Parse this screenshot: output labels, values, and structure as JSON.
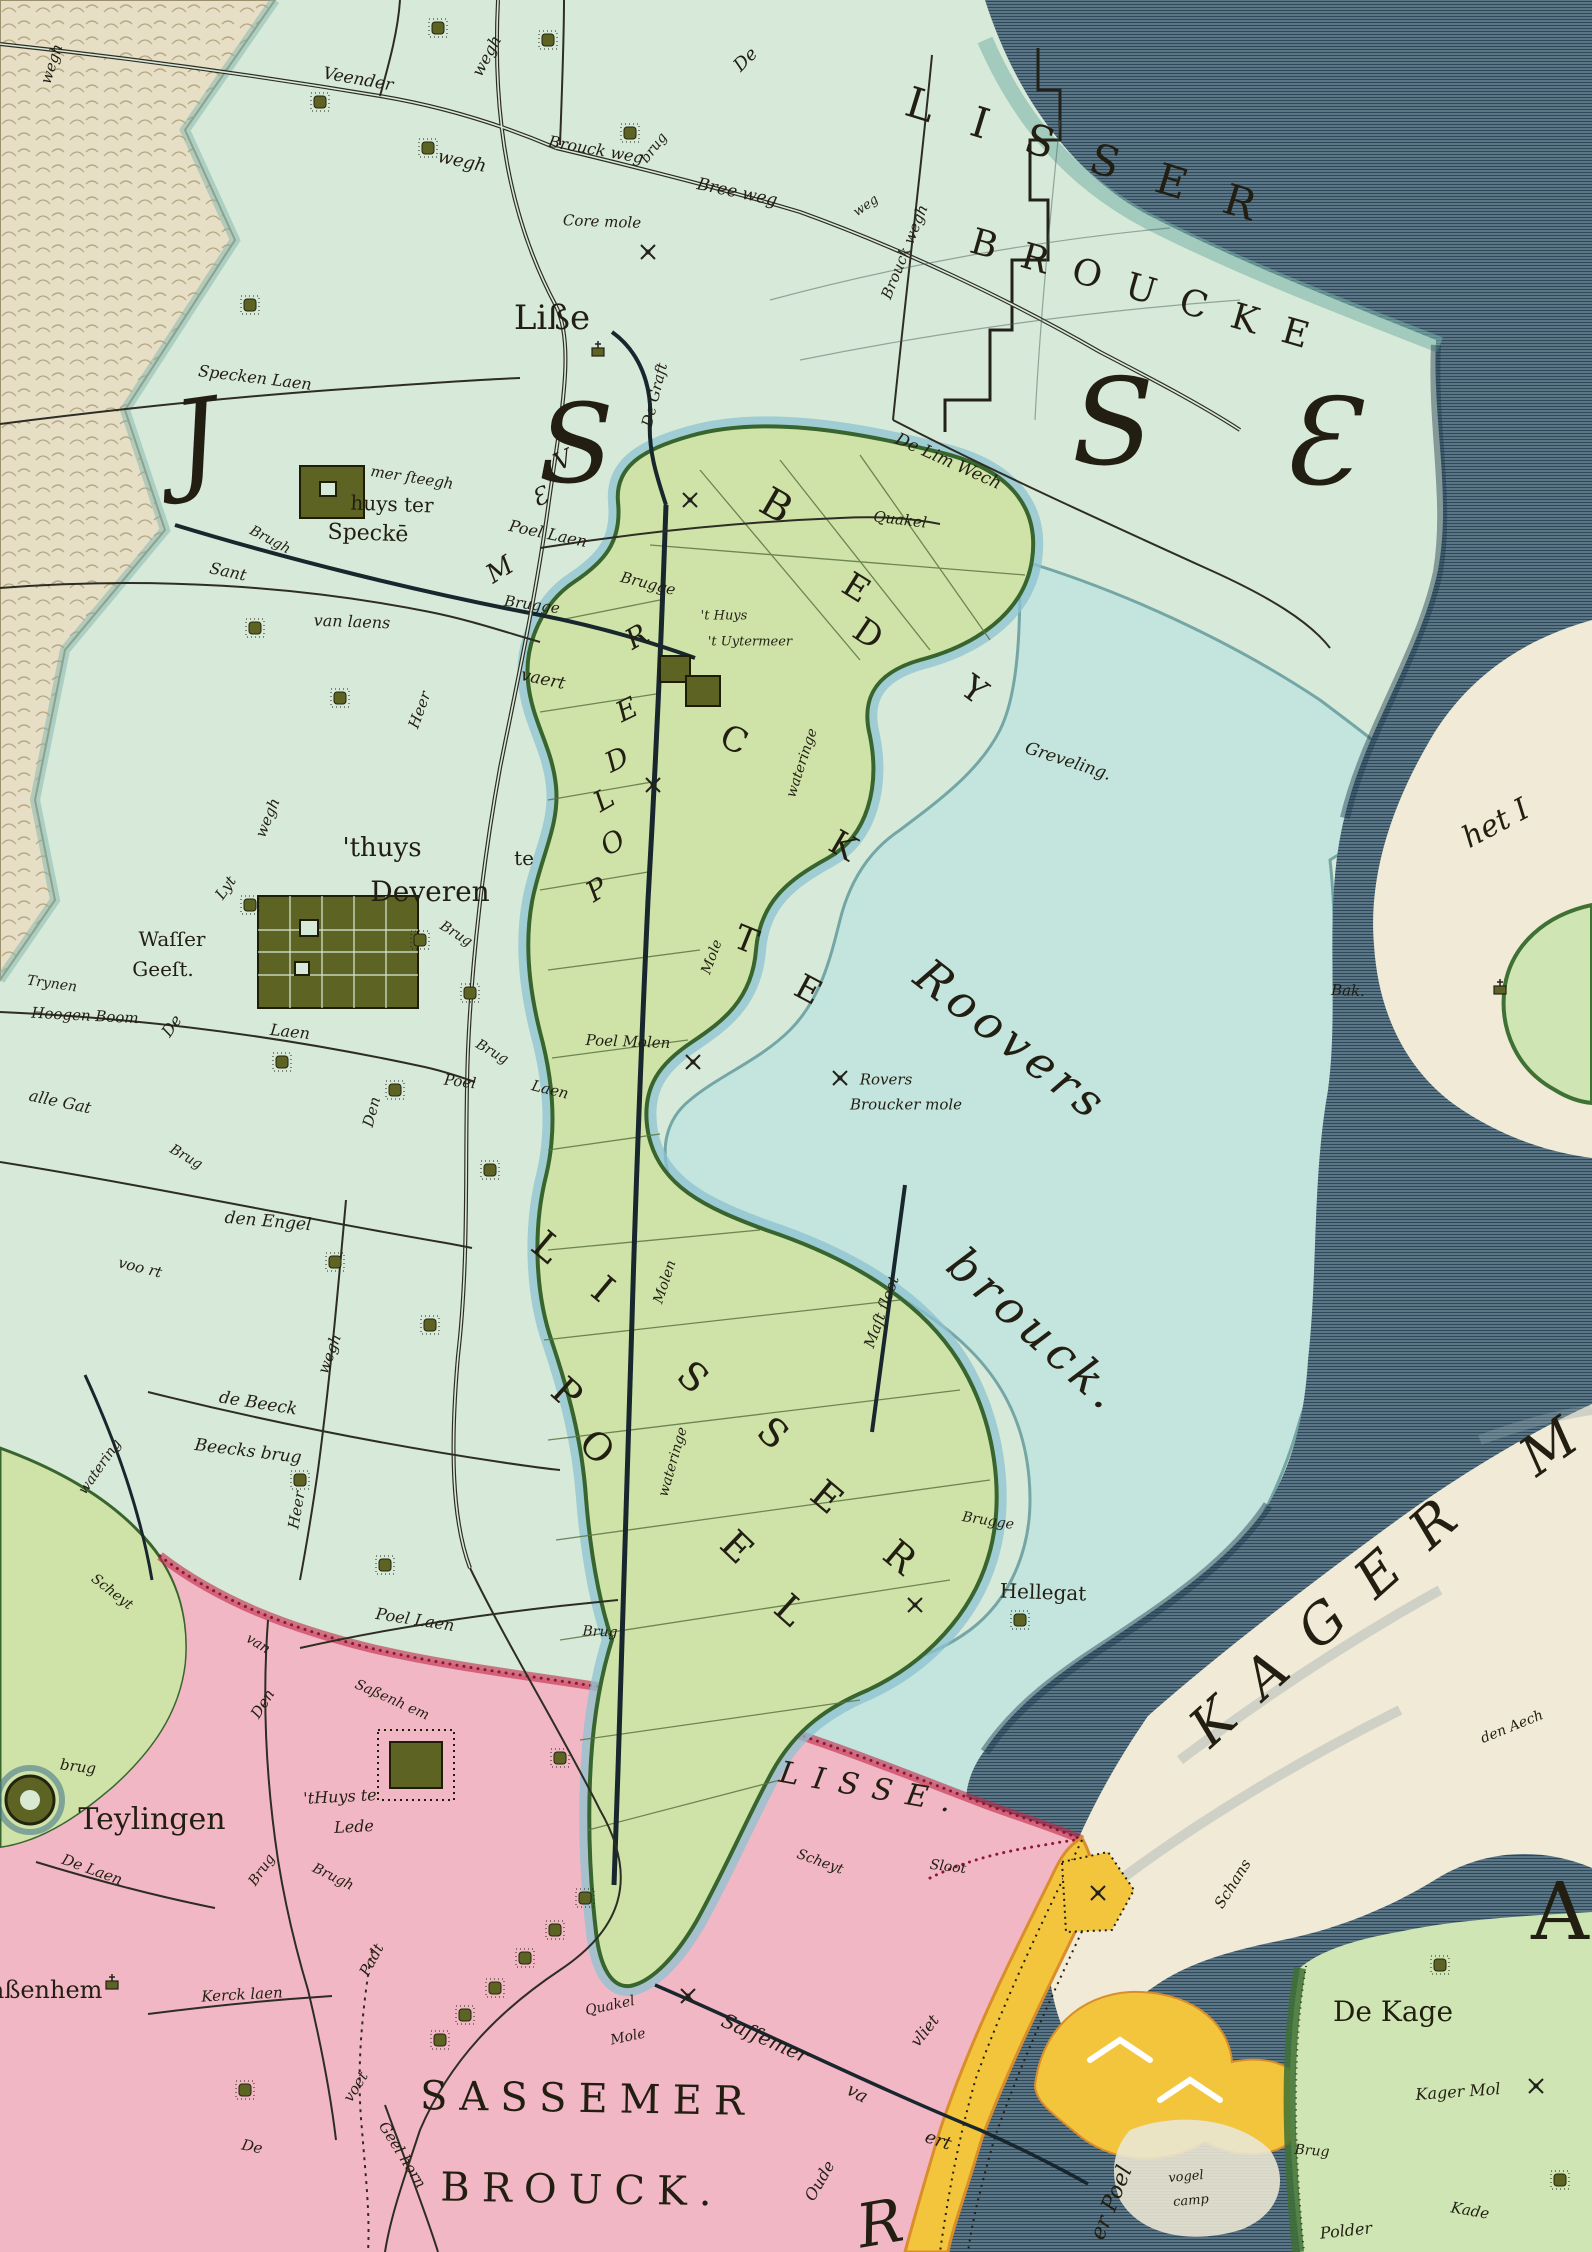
{
  "map_type": "historic-hand-coloured-map",
  "palette": {
    "land_mint": "#d7e9d8",
    "water_light_cyan": "#c3e4df",
    "water_dark": "#5b7585",
    "water_dark_lines": "#2d4a5c",
    "polder_green": "#cfe3a9",
    "polder_rim_green": "#38652e",
    "ring_canal_blue": "#8cc3d2",
    "pink_region": "#f2b7c4",
    "crimson_border": "#c22648",
    "yellow_dike": "#f2c53d",
    "cream_meer": "#f0ead6",
    "dune_sand": "#e6dfc6",
    "island_green": "#cfe6b4",
    "olive_wood": "#5d6322",
    "ink": "#23221a"
  },
  "labels": [
    {
      "id": "wegh_dune",
      "t": "wegh",
      "x": 52,
      "y": 64,
      "r": -72,
      "s": 15
    },
    {
      "id": "veender",
      "t": "Veender",
      "x": 358,
      "y": 80,
      "r": 10,
      "s": 17
    },
    {
      "id": "wegh_n",
      "t": "wegh",
      "x": 487,
      "y": 56,
      "r": -62,
      "s": 16
    },
    {
      "id": "wegh_w",
      "t": "wegh",
      "x": 462,
      "y": 162,
      "r": 12,
      "s": 18
    },
    {
      "id": "brouck_weg",
      "t": "Brouck weg",
      "x": 596,
      "y": 150,
      "r": 10,
      "s": 16
    },
    {
      "id": "brug_top",
      "t": "brug",
      "x": 654,
      "y": 148,
      "r": -52,
      "s": 14
    },
    {
      "id": "bree_weg",
      "t": "Bree weg",
      "x": 737,
      "y": 193,
      "r": 12,
      "s": 17
    },
    {
      "id": "core_mole",
      "t": "Core mole",
      "x": 602,
      "y": 222,
      "r": 2,
      "s": 15
    },
    {
      "id": "de_top",
      "t": "De",
      "x": 746,
      "y": 60,
      "r": -45,
      "s": 18
    },
    {
      "id": "brouck_wegh_v",
      "t": "Brouck wegh",
      "x": 905,
      "y": 252,
      "r": -68,
      "s": 15
    },
    {
      "id": "weg_sm",
      "t": "weg",
      "x": 866,
      "y": 206,
      "r": -35,
      "s": 13
    },
    {
      "id": "de_lim",
      "t": "De Lim Wech",
      "x": 948,
      "y": 462,
      "r": 24,
      "s": 17
    },
    {
      "id": "de_graft",
      "t": "De Graft",
      "x": 655,
      "y": 395,
      "r": -76,
      "s": 15
    },
    {
      "id": "specken_laen",
      "t": "Specken Laen",
      "x": 255,
      "y": 378,
      "r": 7,
      "s": 16
    },
    {
      "id": "mer_steegh",
      "t": "mer ſteegh",
      "x": 412,
      "y": 478,
      "r": 9,
      "s": 15
    },
    {
      "id": "poel_laen_n",
      "t": "Poel Laen",
      "x": 548,
      "y": 534,
      "r": 12,
      "s": 16
    },
    {
      "id": "brugh_w",
      "t": "Brugh",
      "x": 270,
      "y": 540,
      "r": 28,
      "s": 14
    },
    {
      "id": "sant",
      "t": "Sant",
      "x": 228,
      "y": 572,
      "r": 12,
      "s": 16
    },
    {
      "id": "van_laens",
      "t": "van laens",
      "x": 352,
      "y": 622,
      "r": 2,
      "s": 16
    },
    {
      "id": "brugge1",
      "t": "Brugge",
      "x": 532,
      "y": 605,
      "r": 8,
      "s": 15
    },
    {
      "id": "brugge2",
      "t": "Brugge",
      "x": 648,
      "y": 584,
      "r": 14,
      "s": 15
    },
    {
      "id": "vaert",
      "t": "vaert",
      "x": 543,
      "y": 680,
      "r": 12,
      "s": 17
    },
    {
      "id": "heer1",
      "t": "Heer",
      "x": 420,
      "y": 710,
      "r": -70,
      "s": 15
    },
    {
      "id": "quakel",
      "t": "Quakel",
      "x": 900,
      "y": 520,
      "r": 7,
      "s": 15
    },
    {
      "id": "uyter1",
      "t": "'t Huys",
      "x": 724,
      "y": 616,
      "r": 0,
      "s": 13
    },
    {
      "id": "uyter2",
      "t": "'t Uytermeer",
      "x": 750,
      "y": 642,
      "r": 0,
      "s": 13
    },
    {
      "id": "wateringe1",
      "t": "wateringe",
      "x": 802,
      "y": 763,
      "r": -72,
      "s": 14
    },
    {
      "id": "greveling",
      "t": "Greveling.",
      "x": 1068,
      "y": 762,
      "r": 18,
      "s": 17
    },
    {
      "id": "mole_v",
      "t": "Mole",
      "x": 712,
      "y": 957,
      "r": -70,
      "s": 14
    },
    {
      "id": "poel_molen",
      "t": "Poel Molen",
      "x": 628,
      "y": 1042,
      "r": 2,
      "s": 15
    },
    {
      "id": "rovers1",
      "t": "Rovers",
      "x": 886,
      "y": 1080,
      "r": 0,
      "s": 15
    },
    {
      "id": "rovers2",
      "t": "Broucker mole",
      "x": 906,
      "y": 1105,
      "r": 0,
      "s": 15
    },
    {
      "id": "mast_sloot",
      "t": "Maſt ſloot",
      "x": 882,
      "y": 1312,
      "r": -70,
      "s": 15
    },
    {
      "id": "lyt",
      "t": "Lyt",
      "x": 226,
      "y": 888,
      "r": -55,
      "s": 15
    },
    {
      "id": "wegh_lyt",
      "t": "wegh",
      "x": 268,
      "y": 818,
      "r": -68,
      "s": 15
    },
    {
      "id": "trynen",
      "t": "Trynen",
      "x": 52,
      "y": 984,
      "r": 8,
      "s": 14
    },
    {
      "id": "hoogen",
      "t": "Hoogen Boom",
      "x": 85,
      "y": 1016,
      "r": 3,
      "s": 15
    },
    {
      "id": "de_v",
      "t": "De",
      "x": 172,
      "y": 1026,
      "r": -55,
      "s": 16
    },
    {
      "id": "laen_dev",
      "t": "Laen",
      "x": 290,
      "y": 1032,
      "r": 6,
      "s": 16
    },
    {
      "id": "alle_gat",
      "t": "alle Gat",
      "x": 60,
      "y": 1102,
      "r": 12,
      "s": 16
    },
    {
      "id": "brug_sw",
      "t": "Brug",
      "x": 186,
      "y": 1157,
      "r": 30,
      "s": 14
    },
    {
      "id": "brug_dev",
      "t": "Brug",
      "x": 456,
      "y": 934,
      "r": 32,
      "s": 14
    },
    {
      "id": "brug_poel",
      "t": "Brug",
      "x": 492,
      "y": 1052,
      "r": 30,
      "s": 14
    },
    {
      "id": "poel_s",
      "t": "Poel",
      "x": 460,
      "y": 1082,
      "r": 7,
      "s": 15
    },
    {
      "id": "den_v",
      "t": "Den",
      "x": 372,
      "y": 1112,
      "r": -75,
      "s": 15
    },
    {
      "id": "laen_ps",
      "t": "Laen",
      "x": 550,
      "y": 1090,
      "r": 14,
      "s": 15
    },
    {
      "id": "den_engel",
      "t": "den Engel",
      "x": 268,
      "y": 1222,
      "r": 5,
      "s": 17
    },
    {
      "id": "voort",
      "t": "voo rt",
      "x": 140,
      "y": 1268,
      "r": 14,
      "s": 15
    },
    {
      "id": "wegh_s",
      "t": "wegh",
      "x": 330,
      "y": 1354,
      "r": -70,
      "s": 15
    },
    {
      "id": "de_beeck",
      "t": "de Beeck",
      "x": 258,
      "y": 1404,
      "r": 9,
      "s": 17
    },
    {
      "id": "beecks_brug",
      "t": "Beecks brug",
      "x": 248,
      "y": 1452,
      "r": 7,
      "s": 17
    },
    {
      "id": "watering_v",
      "t": "watering",
      "x": 100,
      "y": 1467,
      "r": -55,
      "s": 14
    },
    {
      "id": "heer2",
      "t": "Heer",
      "x": 297,
      "y": 1510,
      "r": -80,
      "s": 15
    },
    {
      "id": "molen_v",
      "t": "Molen",
      "x": 665,
      "y": 1282,
      "r": -72,
      "s": 14
    },
    {
      "id": "wateringe2",
      "t": "wateringe",
      "x": 673,
      "y": 1462,
      "r": -74,
      "s": 14
    },
    {
      "id": "brug_pold",
      "t": "Brug",
      "x": 600,
      "y": 1632,
      "r": 2,
      "s": 14
    },
    {
      "id": "brugge3",
      "t": "Brugge",
      "x": 988,
      "y": 1521,
      "r": 9,
      "s": 14
    },
    {
      "id": "hellegat",
      "t": "Hellegat",
      "x": 1043,
      "y": 1592,
      "r": 2,
      "s": 20,
      "c": "up"
    },
    {
      "id": "scheyt1",
      "t": "Scheyt",
      "x": 820,
      "y": 1862,
      "r": 20,
      "s": 14
    },
    {
      "id": "sloot1",
      "t": "Sloot",
      "x": 948,
      "y": 1867,
      "r": 7,
      "s": 14
    },
    {
      "id": "scheyt2",
      "t": "Scheyt",
      "x": 112,
      "y": 1592,
      "r": 38,
      "s": 14
    },
    {
      "id": "van2",
      "t": "van",
      "x": 258,
      "y": 1644,
      "r": 32,
      "s": 14
    },
    {
      "id": "sassenh2",
      "t": "Saßenh em",
      "x": 392,
      "y": 1700,
      "r": 24,
      "s": 14
    },
    {
      "id": "poel_laen_s",
      "t": "Poel Laen",
      "x": 415,
      "y": 1620,
      "r": 9,
      "s": 16
    },
    {
      "id": "den2",
      "t": "Den",
      "x": 263,
      "y": 1704,
      "r": -58,
      "s": 15
    },
    {
      "id": "brug_tey",
      "t": "brug",
      "x": 78,
      "y": 1767,
      "r": 7,
      "s": 15
    },
    {
      "id": "lede1",
      "t": "'tHuys te",
      "x": 340,
      "y": 1797,
      "r": -3,
      "s": 16
    },
    {
      "id": "lede2",
      "t": "Lede",
      "x": 354,
      "y": 1827,
      "r": -3,
      "s": 16
    },
    {
      "id": "de_laen2",
      "t": "De Laen",
      "x": 92,
      "y": 1870,
      "r": 20,
      "s": 15
    },
    {
      "id": "brug_lede",
      "t": "Brug",
      "x": 262,
      "y": 1870,
      "r": -55,
      "s": 14
    },
    {
      "id": "brugh_lede",
      "t": "Brugh",
      "x": 333,
      "y": 1877,
      "r": 26,
      "s": 14
    },
    {
      "id": "kerck_laen",
      "t": "Kerck laen",
      "x": 242,
      "y": 1995,
      "r": -3,
      "s": 15
    },
    {
      "id": "padt_v",
      "t": "Padt",
      "x": 372,
      "y": 1960,
      "r": -62,
      "s": 15
    },
    {
      "id": "voet_v",
      "t": "voet",
      "x": 356,
      "y": 2087,
      "r": -58,
      "s": 15
    },
    {
      "id": "de_s",
      "t": "De",
      "x": 252,
      "y": 2147,
      "r": 12,
      "s": 15
    },
    {
      "id": "geel_horn",
      "t": "Geel horn",
      "x": 402,
      "y": 2155,
      "r": 58,
      "s": 15
    },
    {
      "id": "quakel2",
      "t": "Quakel",
      "x": 610,
      "y": 2006,
      "r": -12,
      "s": 14
    },
    {
      "id": "mole2",
      "t": "Mole",
      "x": 628,
      "y": 2037,
      "r": -12,
      "s": 14
    },
    {
      "id": "sassemer_sc",
      "t": "Saſſemer",
      "x": 765,
      "y": 2038,
      "r": 24,
      "s": 20
    },
    {
      "id": "va",
      "t": "va",
      "x": 857,
      "y": 2094,
      "r": 28,
      "s": 18
    },
    {
      "id": "ert",
      "t": "ert",
      "x": 938,
      "y": 2141,
      "r": 18,
      "s": 18
    },
    {
      "id": "oude_v",
      "t": "Oude",
      "x": 820,
      "y": 2181,
      "r": -60,
      "s": 16
    },
    {
      "id": "vliet_v",
      "t": "vliet",
      "x": 925,
      "y": 2031,
      "r": -52,
      "s": 16
    },
    {
      "id": "schans",
      "t": "Schans",
      "x": 1233,
      "y": 1884,
      "r": -58,
      "s": 15
    },
    {
      "id": "den_aech",
      "t": "den Aech",
      "x": 1512,
      "y": 1727,
      "r": -22,
      "s": 14
    },
    {
      "id": "kager_mol",
      "t": "Kager Mol",
      "x": 1458,
      "y": 2092,
      "r": -4,
      "s": 16
    },
    {
      "id": "brug_kage",
      "t": "Brug",
      "x": 1312,
      "y": 2151,
      "r": 4,
      "s": 14
    },
    {
      "id": "polder_k",
      "t": "Polder",
      "x": 1346,
      "y": 2231,
      "r": -6,
      "s": 16
    },
    {
      "id": "kade",
      "t": "Kade",
      "x": 1470,
      "y": 2211,
      "r": 10,
      "s": 15
    },
    {
      "id": "vogel1",
      "t": "vogel",
      "x": 1186,
      "y": 2177,
      "r": -5,
      "s": 13
    },
    {
      "id": "vogel2",
      "t": "camp",
      "x": 1191,
      "y": 2201,
      "r": -5,
      "s": 13
    },
    {
      "id": "bak",
      "t": "Bak.",
      "x": 1348,
      "y": 991,
      "r": 2,
      "s": 15
    },
    {
      "id": "lisse_town",
      "t": "Liße",
      "x": 552,
      "y": 318,
      "r": 0,
      "s": 34,
      "c": "up"
    },
    {
      "id": "huys_ter",
      "t": "huys ter",
      "x": 392,
      "y": 504,
      "r": 2,
      "s": 20,
      "c": "up"
    },
    {
      "id": "specke",
      "t": "Speckē",
      "x": 368,
      "y": 534,
      "r": 2,
      "s": 22,
      "c": "up"
    },
    {
      "id": "thuys",
      "t": "'thuys",
      "x": 382,
      "y": 848,
      "r": 0,
      "s": 26,
      "c": "up"
    },
    {
      "id": "te_dev",
      "t": "te",
      "x": 524,
      "y": 858,
      "r": 0,
      "s": 20,
      "c": "up"
    },
    {
      "id": "devieren",
      "t": "Deveren",
      "x": 430,
      "y": 892,
      "r": 0,
      "s": 28,
      "c": "up"
    },
    {
      "id": "waller",
      "t": "Waſſer",
      "x": 172,
      "y": 939,
      "r": 0,
      "s": 20,
      "c": "up"
    },
    {
      "id": "geest",
      "t": "Geeſt.",
      "x": 163,
      "y": 969,
      "r": 0,
      "s": 20,
      "c": "up"
    },
    {
      "id": "teylingen",
      "t": "Teylingen",
      "x": 152,
      "y": 1820,
      "r": 0,
      "s": 30,
      "c": "up"
    },
    {
      "id": "sassenhem_town",
      "t": "Saßenhem",
      "x": 38,
      "y": 1990,
      "r": 0,
      "s": 24,
      "c": "up"
    },
    {
      "id": "de_kage",
      "t": "De Kage",
      "x": 1393,
      "y": 2012,
      "r": 0,
      "s": 28,
      "c": "up"
    },
    {
      "id": "lisser_big",
      "t": "LISSER",
      "x": 1100,
      "y": 160,
      "r": 17,
      "s": 42,
      "c": "up",
      "ls": 40
    },
    {
      "id": "broucke_big",
      "t": "BROUCKE",
      "x": 1152,
      "y": 293,
      "r": 16,
      "s": 36,
      "c": "up",
      "ls": 26
    },
    {
      "id": "sassemer_big",
      "t": "SASSEMER",
      "x": 588,
      "y": 2099,
      "r": 1,
      "s": 40,
      "c": "up",
      "ls": 12
    },
    {
      "id": "brouck_s_big",
      "t": "BROUCK.",
      "x": 582,
      "y": 2190,
      "r": 1,
      "s": 40,
      "c": "up",
      "ls": 12
    },
    {
      "id": "kager_big",
      "t": "KAGER",
      "x": 1336,
      "y": 1612,
      "r": -42,
      "s": 54,
      "ls": 34
    },
    {
      "id": "m_big",
      "t": "M",
      "x": 1549,
      "y": 1447,
      "r": -35,
      "s": 54
    },
    {
      "id": "lisse_inlet",
      "t": "LISSE.",
      "x": 872,
      "y": 1789,
      "r": 10,
      "s": 30,
      "ls": 14
    },
    {
      "id": "roovers_big",
      "t": "Roovers",
      "x": 1012,
      "y": 1040,
      "r": 38,
      "s": 46,
      "ls": 6
    },
    {
      "id": "brouck_big2",
      "t": "brouck.",
      "x": 1036,
      "y": 1330,
      "r": 42,
      "s": 46,
      "ls": 6
    },
    {
      "id": "er_poel",
      "t": "er Poel",
      "x": 1112,
      "y": 2203,
      "r": -68,
      "s": 22
    },
    {
      "id": "het_i",
      "t": "het I",
      "x": 1496,
      "y": 824,
      "r": -28,
      "s": 30
    },
    {
      "id": "big_r",
      "t": "R",
      "x": 880,
      "y": 2224,
      "r": -10,
      "s": 60
    },
    {
      "id": "big_a",
      "t": "A",
      "x": 1560,
      "y": 1912,
      "r": 0,
      "s": 80,
      "c": "up"
    },
    {
      "id": "g1",
      "t": "J",
      "x": 196,
      "y": 440,
      "r": -8,
      "s": 110
    },
    {
      "id": "g2",
      "t": "S",
      "x": 576,
      "y": 444,
      "r": 0,
      "s": 110
    },
    {
      "id": "g3",
      "t": "S",
      "x": 1113,
      "y": 424,
      "r": 0,
      "s": 120
    },
    {
      "id": "g4",
      "t": "Ɛ",
      "x": 1318,
      "y": 444,
      "r": 0,
      "s": 120
    },
    {
      "id": "b1",
      "t": "B",
      "x": 776,
      "y": 506,
      "r": 30,
      "s": 40,
      "c": "up"
    },
    {
      "id": "b2",
      "t": "E",
      "x": 856,
      "y": 588,
      "r": 32,
      "s": 34,
      "c": "up"
    },
    {
      "id": "b3",
      "t": "D",
      "x": 868,
      "y": 634,
      "r": 34,
      "s": 34,
      "c": "up"
    },
    {
      "id": "b4",
      "t": "Y",
      "x": 974,
      "y": 690,
      "r": 36,
      "s": 34,
      "c": "up"
    },
    {
      "id": "b5",
      "t": "C",
      "x": 734,
      "y": 740,
      "r": 25,
      "s": 34,
      "c": "up"
    },
    {
      "id": "b6",
      "t": "K",
      "x": 843,
      "y": 846,
      "r": 30,
      "s": 34,
      "c": "up"
    },
    {
      "id": "b7",
      "t": "T",
      "x": 746,
      "y": 940,
      "r": 22,
      "s": 34,
      "c": "up"
    },
    {
      "id": "b8",
      "t": "E",
      "x": 808,
      "y": 990,
      "r": 28,
      "s": 34,
      "c": "up"
    },
    {
      "id": "l1",
      "t": "L",
      "x": 547,
      "y": 1247,
      "r": 40,
      "s": 38,
      "c": "up"
    },
    {
      "id": "l2",
      "t": "I",
      "x": 603,
      "y": 1289,
      "r": 40,
      "s": 38,
      "c": "up"
    },
    {
      "id": "l3",
      "t": "S",
      "x": 693,
      "y": 1377,
      "r": 42,
      "s": 38,
      "c": "up"
    },
    {
      "id": "l4",
      "t": "S",
      "x": 773,
      "y": 1433,
      "r": 42,
      "s": 38,
      "c": "up"
    },
    {
      "id": "l5",
      "t": "E",
      "x": 827,
      "y": 1497,
      "r": 40,
      "s": 38,
      "c": "up"
    },
    {
      "id": "l6",
      "t": "R",
      "x": 900,
      "y": 1557,
      "r": 40,
      "s": 38,
      "c": "up"
    },
    {
      "id": "p1",
      "t": "P",
      "x": 567,
      "y": 1393,
      "r": 42,
      "s": 38,
      "c": "up"
    },
    {
      "id": "p2",
      "t": "O",
      "x": 597,
      "y": 1447,
      "r": 44,
      "s": 38,
      "c": "up"
    },
    {
      "id": "p3",
      "t": "E",
      "x": 737,
      "y": 1547,
      "r": 44,
      "s": 38,
      "c": "up"
    },
    {
      "id": "p4",
      "t": "L",
      "x": 790,
      "y": 1610,
      "r": 42,
      "s": 38,
      "c": "up"
    },
    {
      "id": "q1",
      "t": "P",
      "x": 597,
      "y": 890,
      "r": -32,
      "s": 28
    },
    {
      "id": "q2",
      "t": "O",
      "x": 613,
      "y": 843,
      "r": -30,
      "s": 28
    },
    {
      "id": "q3",
      "t": "L",
      "x": 604,
      "y": 800,
      "r": -30,
      "s": 28
    },
    {
      "id": "q4",
      "t": "D",
      "x": 617,
      "y": 760,
      "r": -26,
      "s": 28
    },
    {
      "id": "q5",
      "t": "E",
      "x": 627,
      "y": 710,
      "r": -26,
      "s": 28
    },
    {
      "id": "q6",
      "t": "R",
      "x": 637,
      "y": 637,
      "r": -30,
      "s": 28
    },
    {
      "id": "s1",
      "t": "V",
      "x": 563,
      "y": 460,
      "r": -25,
      "s": 24
    },
    {
      "id": "s2",
      "t": "Ɛ",
      "x": 540,
      "y": 497,
      "r": -25,
      "s": 24
    },
    {
      "id": "s3",
      "t": "M",
      "x": 500,
      "y": 570,
      "r": -32,
      "s": 26
    }
  ]
}
